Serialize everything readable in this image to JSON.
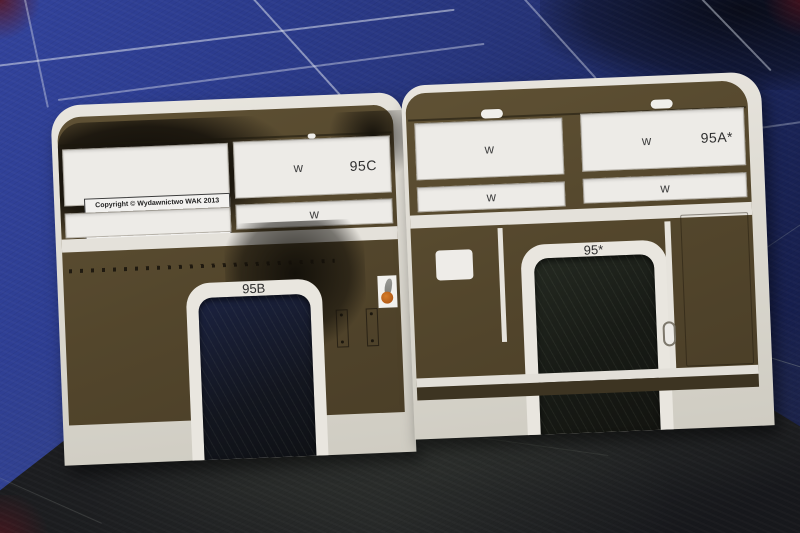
{
  "copyright_label": {
    "line1": "Copyright © Wydawnictwo WAK 2013",
    "line2": "All rights reserved.",
    "line3": "No permission to copy or electronic processing.",
    "line4": "WWW.WAK.PL"
  },
  "parts": {
    "left_window_panel": {
      "glass_letter": "w",
      "part_number": "95C"
    },
    "left_lower_strip": {
      "glass_letter": "w"
    },
    "left_arch": {
      "part_number": "95B"
    },
    "right_window_panel_a": {
      "glass_letter": "w"
    },
    "right_strip_a": {
      "glass_letter": "w"
    },
    "right_window_panel_b": {
      "glass_letter": "w",
      "part_number": "95A*"
    },
    "right_strip_b": {
      "glass_letter": "w"
    },
    "right_arch": {
      "part_number": "95*"
    }
  },
  "colors": {
    "mat_blue": "#2c3c8e",
    "mat_dark": "#17181c",
    "panel_brown": "#57492f",
    "panel_brown_dark": "#3d3422",
    "sheet_white": "#dfdcd4",
    "window_white": "#edebe7",
    "soot_black": "#0e0b07",
    "emblem_orange": "#c2661c",
    "grid_line": "#dae0ec"
  }
}
